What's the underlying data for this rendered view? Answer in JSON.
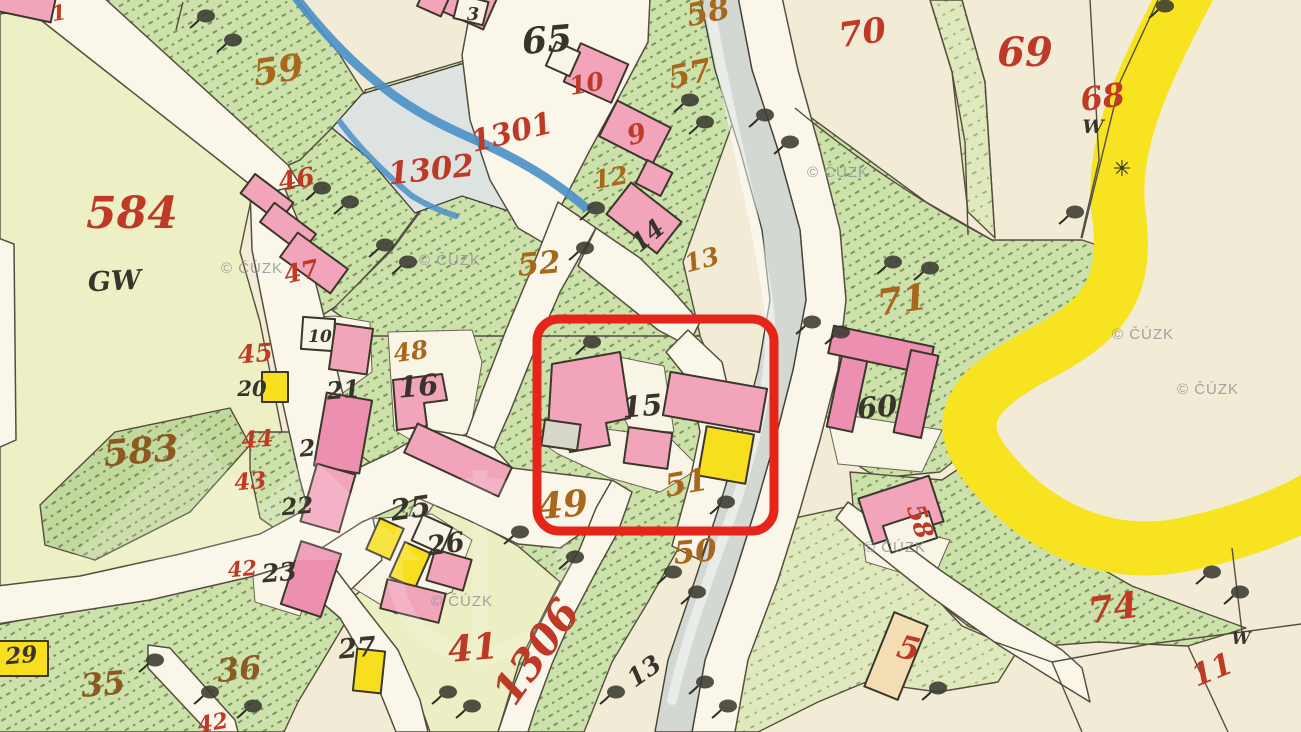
{
  "map": {
    "watermark_text": "© ČÚZK",
    "palette": {
      "paper": "#f2ecd6",
      "meadow_green": "#cde1ab",
      "meadow_dark": "#c3d89d",
      "field_pale": "#edf0c5",
      "pond_grey_blue": "#dde3e1",
      "river_grey": "#d3d8d3",
      "stream_blue": "#4a90c8",
      "road_white": "#faf6ea",
      "road_tan": "#f2c493",
      "road_yellow": "#f8e320",
      "building_pink": "#f1a4ba",
      "building_yellow": "#f7df1d",
      "building_tan": "#f3ddb2",
      "ink": "#4c4437",
      "label_red": "#bf3a26",
      "label_orange": "#a8681c",
      "label_brown": "#8a5a22",
      "label_black": "#39342b",
      "watermark_grey": "#8d8f93",
      "annotation_red": "#e52519"
    },
    "annotation_box": {
      "x": 537,
      "y": 319,
      "width": 237,
      "height": 212,
      "radius": 22,
      "stroke_width": 9
    },
    "labels": [
      {
        "t": "584",
        "x": 132,
        "y": 228,
        "s": 44,
        "c": "red",
        "r": 0
      },
      {
        "t": "59",
        "x": 280,
        "y": 82,
        "s": 36,
        "c": "orange",
        "r": -8
      },
      {
        "t": "46",
        "x": 298,
        "y": 188,
        "s": 26,
        "c": "red",
        "r": -10
      },
      {
        "t": "47",
        "x": 303,
        "y": 280,
        "s": 25,
        "c": "red",
        "r": -12
      },
      {
        "t": "45",
        "x": 256,
        "y": 362,
        "s": 25,
        "c": "red",
        "r": -5
      },
      {
        "t": "44",
        "x": 258,
        "y": 447,
        "s": 23,
        "c": "red",
        "r": -5
      },
      {
        "t": "43",
        "x": 251,
        "y": 489,
        "s": 23,
        "c": "red",
        "r": -5
      },
      {
        "t": "42",
        "x": 243,
        "y": 576,
        "s": 21,
        "c": "red",
        "r": -5
      },
      {
        "t": "42",
        "x": 214,
        "y": 730,
        "s": 22,
        "c": "red",
        "r": -10
      },
      {
        "t": "1301",
        "x": 514,
        "y": 142,
        "s": 30,
        "c": "red",
        "r": -14
      },
      {
        "t": "1302",
        "x": 432,
        "y": 180,
        "s": 31,
        "c": "red",
        "r": -6
      },
      {
        "t": "1306",
        "x": 548,
        "y": 660,
        "s": 42,
        "c": "red",
        "r": -55
      },
      {
        "t": "41",
        "x": 474,
        "y": 660,
        "s": 36,
        "c": "red",
        "r": -5
      },
      {
        "t": "9",
        "x": 639,
        "y": 143,
        "s": 27,
        "c": "red",
        "r": -15
      },
      {
        "t": "10",
        "x": 588,
        "y": 92,
        "s": 25,
        "c": "red",
        "r": -10
      },
      {
        "t": "70",
        "x": 864,
        "y": 44,
        "s": 34,
        "c": "red",
        "r": -8
      },
      {
        "t": "69",
        "x": 1025,
        "y": 66,
        "s": 40,
        "c": "red",
        "r": 0
      },
      {
        "t": "68",
        "x": 1104,
        "y": 108,
        "s": 32,
        "c": "red",
        "r": -8
      },
      {
        "t": "71",
        "x": 904,
        "y": 312,
        "s": 36,
        "c": "orange",
        "r": -8
      },
      {
        "t": "74",
        "x": 1115,
        "y": 620,
        "s": 36,
        "c": "red",
        "r": -8
      },
      {
        "t": "11",
        "x": 1216,
        "y": 679,
        "s": 30,
        "c": "red",
        "r": -22
      },
      {
        "t": "5",
        "x": 906,
        "y": 659,
        "s": 32,
        "c": "red",
        "r": 14
      },
      {
        "t": "58",
        "x": 912,
        "y": 524,
        "s": 25,
        "c": "red",
        "r": 72
      },
      {
        "t": "49",
        "x": 564,
        "y": 517,
        "s": 36,
        "c": "orange",
        "r": -5
      },
      {
        "t": "51",
        "x": 688,
        "y": 493,
        "s": 31,
        "c": "orange",
        "r": -10
      },
      {
        "t": "50",
        "x": 696,
        "y": 562,
        "s": 31,
        "c": "orange",
        "r": -5
      },
      {
        "t": "35",
        "x": 104,
        "y": 695,
        "s": 32,
        "c": "brown",
        "r": -5
      },
      {
        "t": "36",
        "x": 240,
        "y": 680,
        "s": 32,
        "c": "brown",
        "r": -5
      },
      {
        "t": "583",
        "x": 142,
        "y": 463,
        "s": 36,
        "c": "brown",
        "r": -5
      },
      {
        "t": "57",
        "x": 692,
        "y": 84,
        "s": 31,
        "c": "orange",
        "r": -12
      },
      {
        "t": "58",
        "x": 710,
        "y": 22,
        "s": 31,
        "c": "orange",
        "r": -12
      },
      {
        "t": "52",
        "x": 540,
        "y": 274,
        "s": 31,
        "c": "orange",
        "r": -5
      },
      {
        "t": "48",
        "x": 412,
        "y": 360,
        "s": 25,
        "c": "orange",
        "r": -8
      },
      {
        "t": "12",
        "x": 612,
        "y": 186,
        "s": 25,
        "c": "orange",
        "r": -10
      },
      {
        "t": "13",
        "x": 704,
        "y": 268,
        "s": 25,
        "c": "orange",
        "r": -15
      },
      {
        "t": "1",
        "x": 60,
        "y": 20,
        "s": 21,
        "c": "red",
        "r": -10
      },
      {
        "t": "65",
        "x": 548,
        "y": 52,
        "s": 36,
        "c": "black",
        "r": -5
      },
      {
        "t": "3",
        "x": 473,
        "y": 20,
        "s": 18,
        "c": "black",
        "r": 0
      },
      {
        "t": "GW",
        "x": 115,
        "y": 290,
        "s": 27,
        "c": "black",
        "r": -3
      },
      {
        "t": "10",
        "x": 320,
        "y": 342,
        "s": 17,
        "c": "black",
        "r": 0
      },
      {
        "t": "16",
        "x": 419,
        "y": 396,
        "s": 29,
        "c": "black",
        "r": -5
      },
      {
        "t": "21",
        "x": 344,
        "y": 398,
        "s": 24,
        "c": "black",
        "r": -5
      },
      {
        "t": "20",
        "x": 252,
        "y": 396,
        "s": 21,
        "c": "black",
        "r": 0
      },
      {
        "t": "2",
        "x": 308,
        "y": 456,
        "s": 23,
        "c": "black",
        "r": -5
      },
      {
        "t": "22",
        "x": 298,
        "y": 514,
        "s": 23,
        "c": "black",
        "r": -5
      },
      {
        "t": "23",
        "x": 280,
        "y": 581,
        "s": 25,
        "c": "black",
        "r": -5
      },
      {
        "t": "25",
        "x": 412,
        "y": 518,
        "s": 29,
        "c": "black",
        "r": -8
      },
      {
        "t": "26",
        "x": 447,
        "y": 553,
        "s": 27,
        "c": "black",
        "r": -8
      },
      {
        "t": "27",
        "x": 358,
        "y": 657,
        "s": 27,
        "c": "black",
        "r": -5
      },
      {
        "t": "29",
        "x": 22,
        "y": 663,
        "s": 23,
        "c": "black",
        "r": -5
      },
      {
        "t": "13",
        "x": 649,
        "y": 678,
        "s": 25,
        "c": "black",
        "r": -35
      },
      {
        "t": "14",
        "x": 653,
        "y": 242,
        "s": 25,
        "c": "black",
        "r": -40
      },
      {
        "t": "60",
        "x": 878,
        "y": 417,
        "s": 29,
        "c": "black",
        "r": -5
      },
      {
        "t": "15",
        "x": 643,
        "y": 416,
        "s": 29,
        "c": "black",
        "r": -5
      },
      {
        "t": "W",
        "x": 1093,
        "y": 133,
        "s": 19,
        "c": "black",
        "r": 0
      },
      {
        "t": "W",
        "x": 1241,
        "y": 644,
        "s": 17,
        "c": "black",
        "r": 0
      }
    ],
    "watermarks": [
      {
        "x": 252,
        "y": 273
      },
      {
        "x": 450,
        "y": 265
      },
      {
        "x": 838,
        "y": 177
      },
      {
        "x": 1143,
        "y": 339
      },
      {
        "x": 1208,
        "y": 394
      },
      {
        "x": 895,
        "y": 552
      },
      {
        "x": 462,
        "y": 606
      }
    ],
    "symbols": [
      {
        "glyph": "✳",
        "x": 1122,
        "y": 176,
        "size": 22
      }
    ],
    "trees": [
      [
        206,
        16
      ],
      [
        233,
        40
      ],
      [
        322,
        188
      ],
      [
        350,
        202
      ],
      [
        385,
        245
      ],
      [
        408,
        262
      ],
      [
        596,
        208
      ],
      [
        585,
        248
      ],
      [
        690,
        100
      ],
      [
        705,
        122
      ],
      [
        765,
        115
      ],
      [
        790,
        142
      ],
      [
        592,
        342
      ],
      [
        726,
        502
      ],
      [
        520,
        532
      ],
      [
        575,
        557
      ],
      [
        893,
        262
      ],
      [
        930,
        268
      ],
      [
        812,
        322
      ],
      [
        841,
        332
      ],
      [
        1075,
        212
      ],
      [
        1165,
        6
      ],
      [
        1240,
        592
      ],
      [
        1212,
        572
      ],
      [
        673,
        572
      ],
      [
        697,
        592
      ],
      [
        448,
        692
      ],
      [
        472,
        706
      ],
      [
        616,
        692
      ],
      [
        705,
        682
      ],
      [
        728,
        706
      ],
      [
        938,
        688
      ],
      [
        155,
        660
      ],
      [
        210,
        692
      ],
      [
        253,
        706
      ]
    ]
  }
}
